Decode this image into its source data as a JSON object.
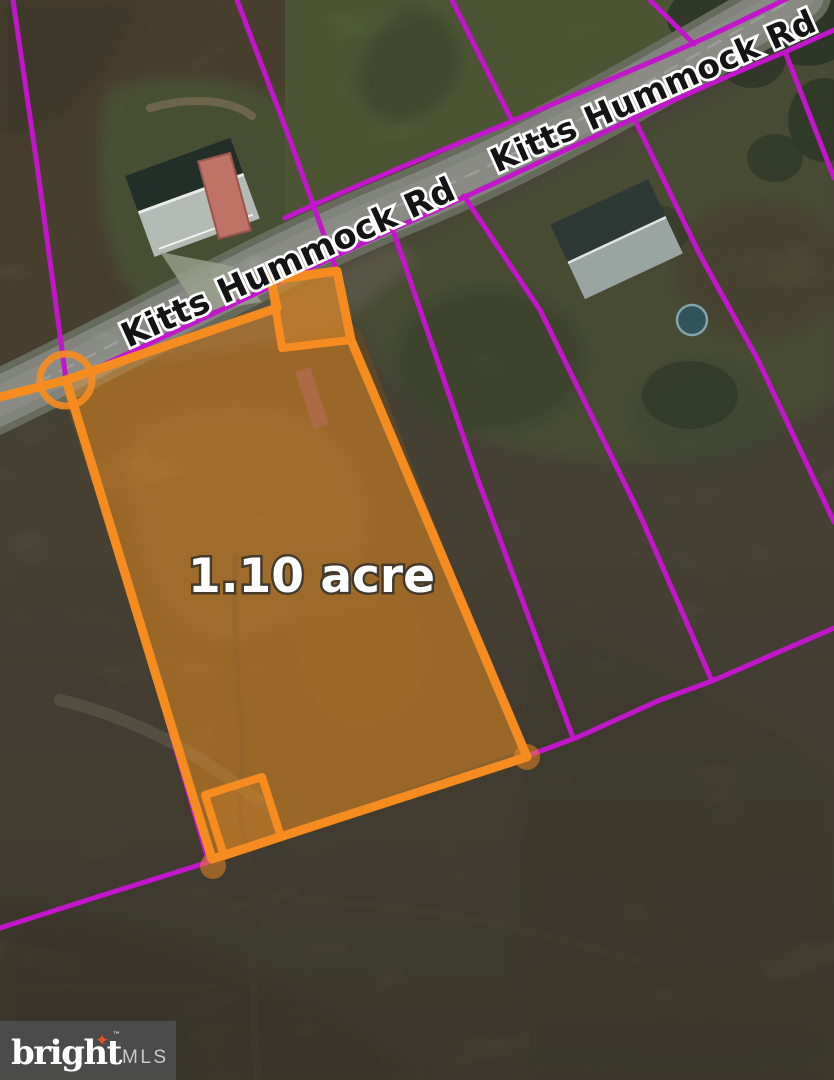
{
  "map": {
    "road": {
      "name_upper": "Kitts Hummock Rd",
      "name_lower": "Kitts Hummock Rd"
    },
    "parcel": {
      "area_label": "1.10 acre",
      "outline_color": "#F68C1F",
      "fill_color": "rgba(244,148,40,0.42)"
    },
    "boundaries": {
      "line_color": "#C315CB"
    }
  },
  "watermark": {
    "brand": "bright",
    "trademark": "™",
    "suffix": "MLS",
    "star_icon": "four-point-star",
    "star_glyph": "✦",
    "star_color": "#E2532E",
    "bg_color": "#4D4D4D"
  }
}
